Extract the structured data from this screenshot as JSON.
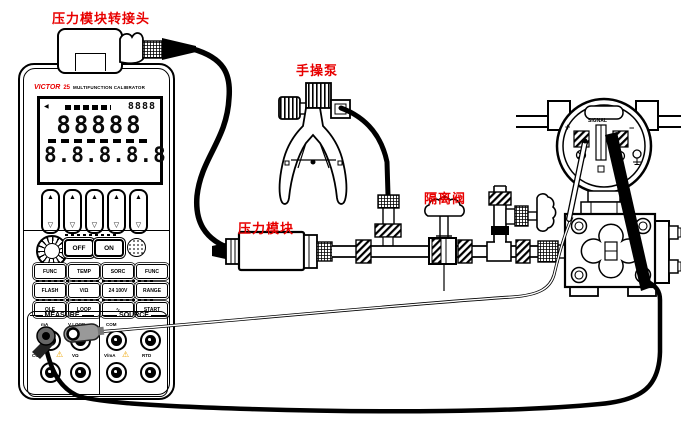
{
  "annotations": {
    "adapter_label": "压力模块转接头",
    "pump_label": "手操泵",
    "module_label": "压力模块",
    "valve_label": "隔离阀"
  },
  "calibrator": {
    "brand": "VICTOR",
    "model": "25",
    "name": "MULTIFUNCTION CALIBRATOR",
    "display": {
      "aux": "8888",
      "row1": "88888",
      "row2": "8.8.8.8.8"
    },
    "power": {
      "off": "OFF",
      "on": "ON"
    },
    "keys": [
      "FUNC",
      "TEMP",
      "SORC",
      "FUNC",
      "FLASH",
      "V/Ω",
      "24 100V",
      "RANGE",
      "OLE",
      "LOOP",
      "∿",
      "START"
    ],
    "sections": {
      "measure": "MEASURE",
      "source": "SOURCE"
    },
    "jack_labels": {
      "m1": "mA",
      "m2": "V LOOP",
      "m3": "COM",
      "m4": "VΩ",
      "s1": "COM",
      "s3": "V/mA",
      "s4": "RTD"
    }
  },
  "transmitter": {
    "signal": "SIGNAL",
    "plus": "+",
    "minus": "−"
  },
  "icons": {
    "up": "▲",
    "down": "▽",
    "left_tri": "◀",
    "warn": "⚠"
  },
  "colors": {
    "label_red": "#e80000",
    "plug_gray": "#999999",
    "warn_yellow": "#eda400"
  }
}
